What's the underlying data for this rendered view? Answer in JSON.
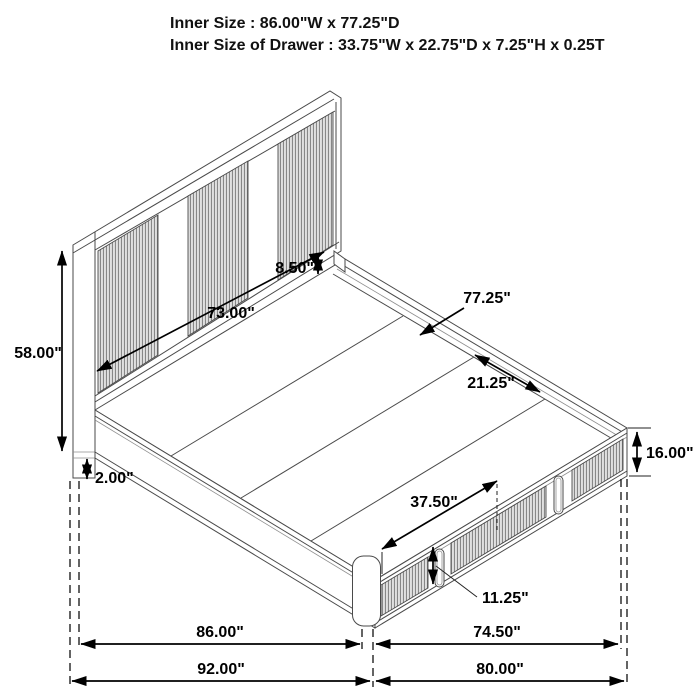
{
  "header": {
    "line1": "Inner Size : 86.00\"W x 77.25\"D",
    "line2": "Inner Size of Drawer : 33.75\"W x 22.75\"D x 7.25\"H x 0.25T"
  },
  "dimensions": {
    "headboard_height": "58.00\"",
    "headboard_inner_width": "73.00\"",
    "headboard_gap": "8.50\"",
    "inner_depth": "77.25\"",
    "slat_panel_width": "21.25\"",
    "drawer_front_width": "37.50\"",
    "drawer_front_height": "11.25\"",
    "platform_height": "16.00\"",
    "leg_reveal": "2.00\"",
    "inner_width": "86.00\"",
    "foot_inner_width": "74.50\"",
    "outer_width": "92.00\"",
    "foot_outer_width": "80.00\""
  },
  "colors": {
    "background": "#ffffff",
    "line": "#4a4a4a",
    "dimension": "#000000",
    "panel_fill": "#e0e0e0",
    "panel_rib": "#777777"
  }
}
